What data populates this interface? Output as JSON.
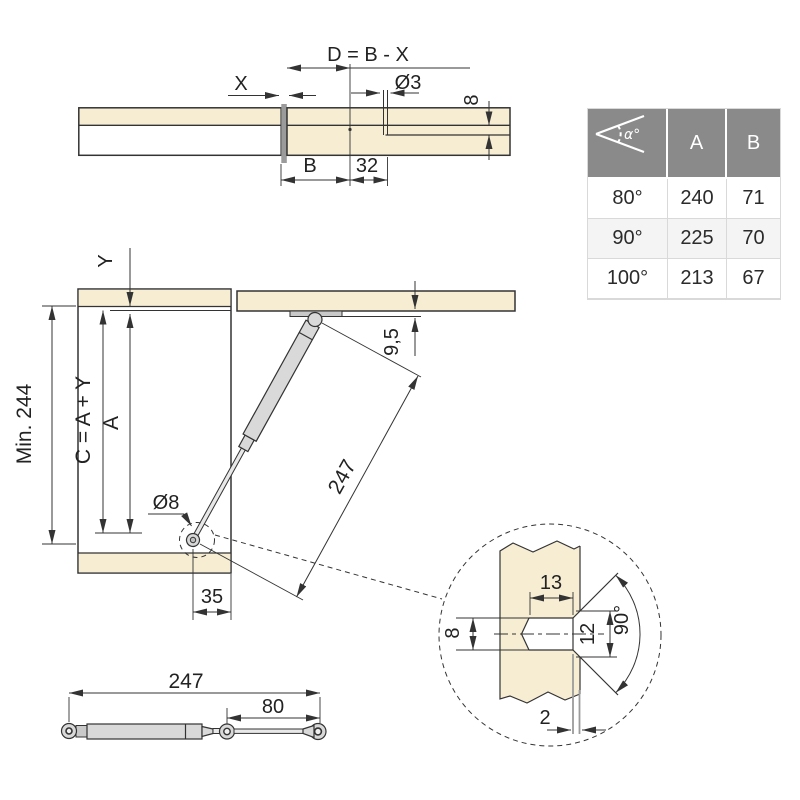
{
  "colors": {
    "wood": "#F6EDD3",
    "line": "#333333",
    "text": "#222222",
    "gray_bar": "#9B9B9B",
    "metal": "#D9D9D9",
    "metal2": "#E8E8E8",
    "plate": "#C9C9C9",
    "table_header": "#8A8A8A"
  },
  "top_view": {
    "dim_d": "D = B - X",
    "dim_x": "X",
    "dim_hole_dia": "Ø3",
    "dim_depth": "8",
    "dim_b": "B",
    "dim_offset": "32"
  },
  "angle_table": {
    "header": {
      "angle_icon_label": "α°",
      "col_a": "A",
      "col_b": "B"
    },
    "rows": [
      {
        "angle": "80°",
        "a": "240",
        "b": "71"
      },
      {
        "angle": "90°",
        "a": "225",
        "b": "70"
      },
      {
        "angle": "100°",
        "a": "213",
        "b": "67"
      }
    ]
  },
  "side_view": {
    "dim_y": "Y",
    "dim_min_height": "Min. 244",
    "dim_c": "C = A + Y",
    "dim_a": "A",
    "dim_lid_offset": "9,5",
    "dim_strut_length": "247",
    "dim_pin_dia": "Ø8",
    "dim_pivot_inset": "35"
  },
  "detail_view": {
    "dim_hole_depth": "13",
    "dim_hole_dia": "8",
    "dim_countersink_dia": "12",
    "dim_countersink_angle": "90°",
    "dim_edge_gap": "2"
  },
  "strut_view": {
    "dim_total_length": "247",
    "dim_rod_length": "80"
  }
}
